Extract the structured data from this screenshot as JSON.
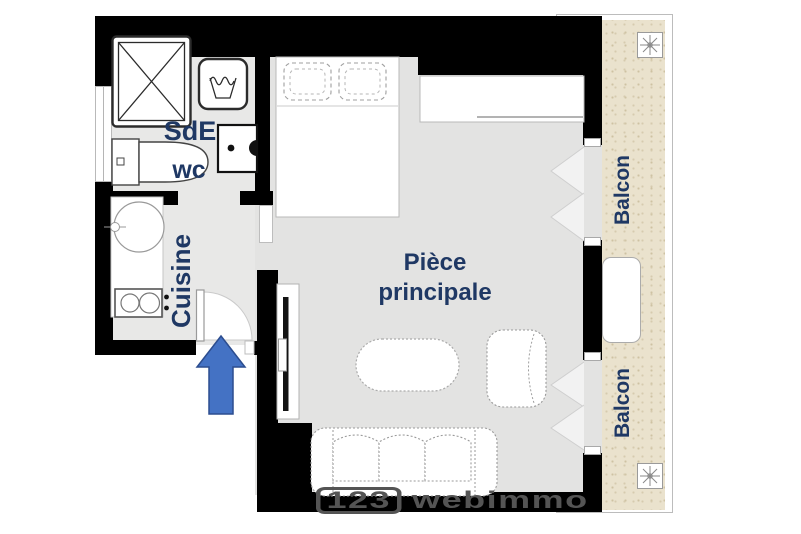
{
  "plan": {
    "title": "Studio apartment floor plan",
    "rooms": {
      "sde": "SdE",
      "wc": "wc",
      "cuisine": "Cuisine",
      "main_line1": "Pièce",
      "main_line2": "principale",
      "balcon_upper": "Balcon",
      "balcon_lower": "Balcon"
    },
    "watermark": {
      "prefix": "123",
      "name": "webimmo"
    },
    "colors": {
      "wall": "#000000",
      "room_label": "#1f3864",
      "floor_main": "#e3e3e2",
      "floor_wet": "#e8e8e7",
      "balcony_floor": "#eae2cd",
      "arrow_fill": "#4472c4",
      "arrow_border": "#2c4d8f",
      "watermark_gray": "#545454"
    },
    "fixtures": [
      "shower",
      "washing-machine",
      "washbasin",
      "toilet",
      "kitchen-sink",
      "stove",
      "entrance-door",
      "entrance-arrow",
      "bed",
      "wardrobe",
      "tv-stand",
      "coffee-table",
      "armchair",
      "sofa",
      "french-window",
      "french-window",
      "balcony-table",
      "plant",
      "plant"
    ]
  }
}
